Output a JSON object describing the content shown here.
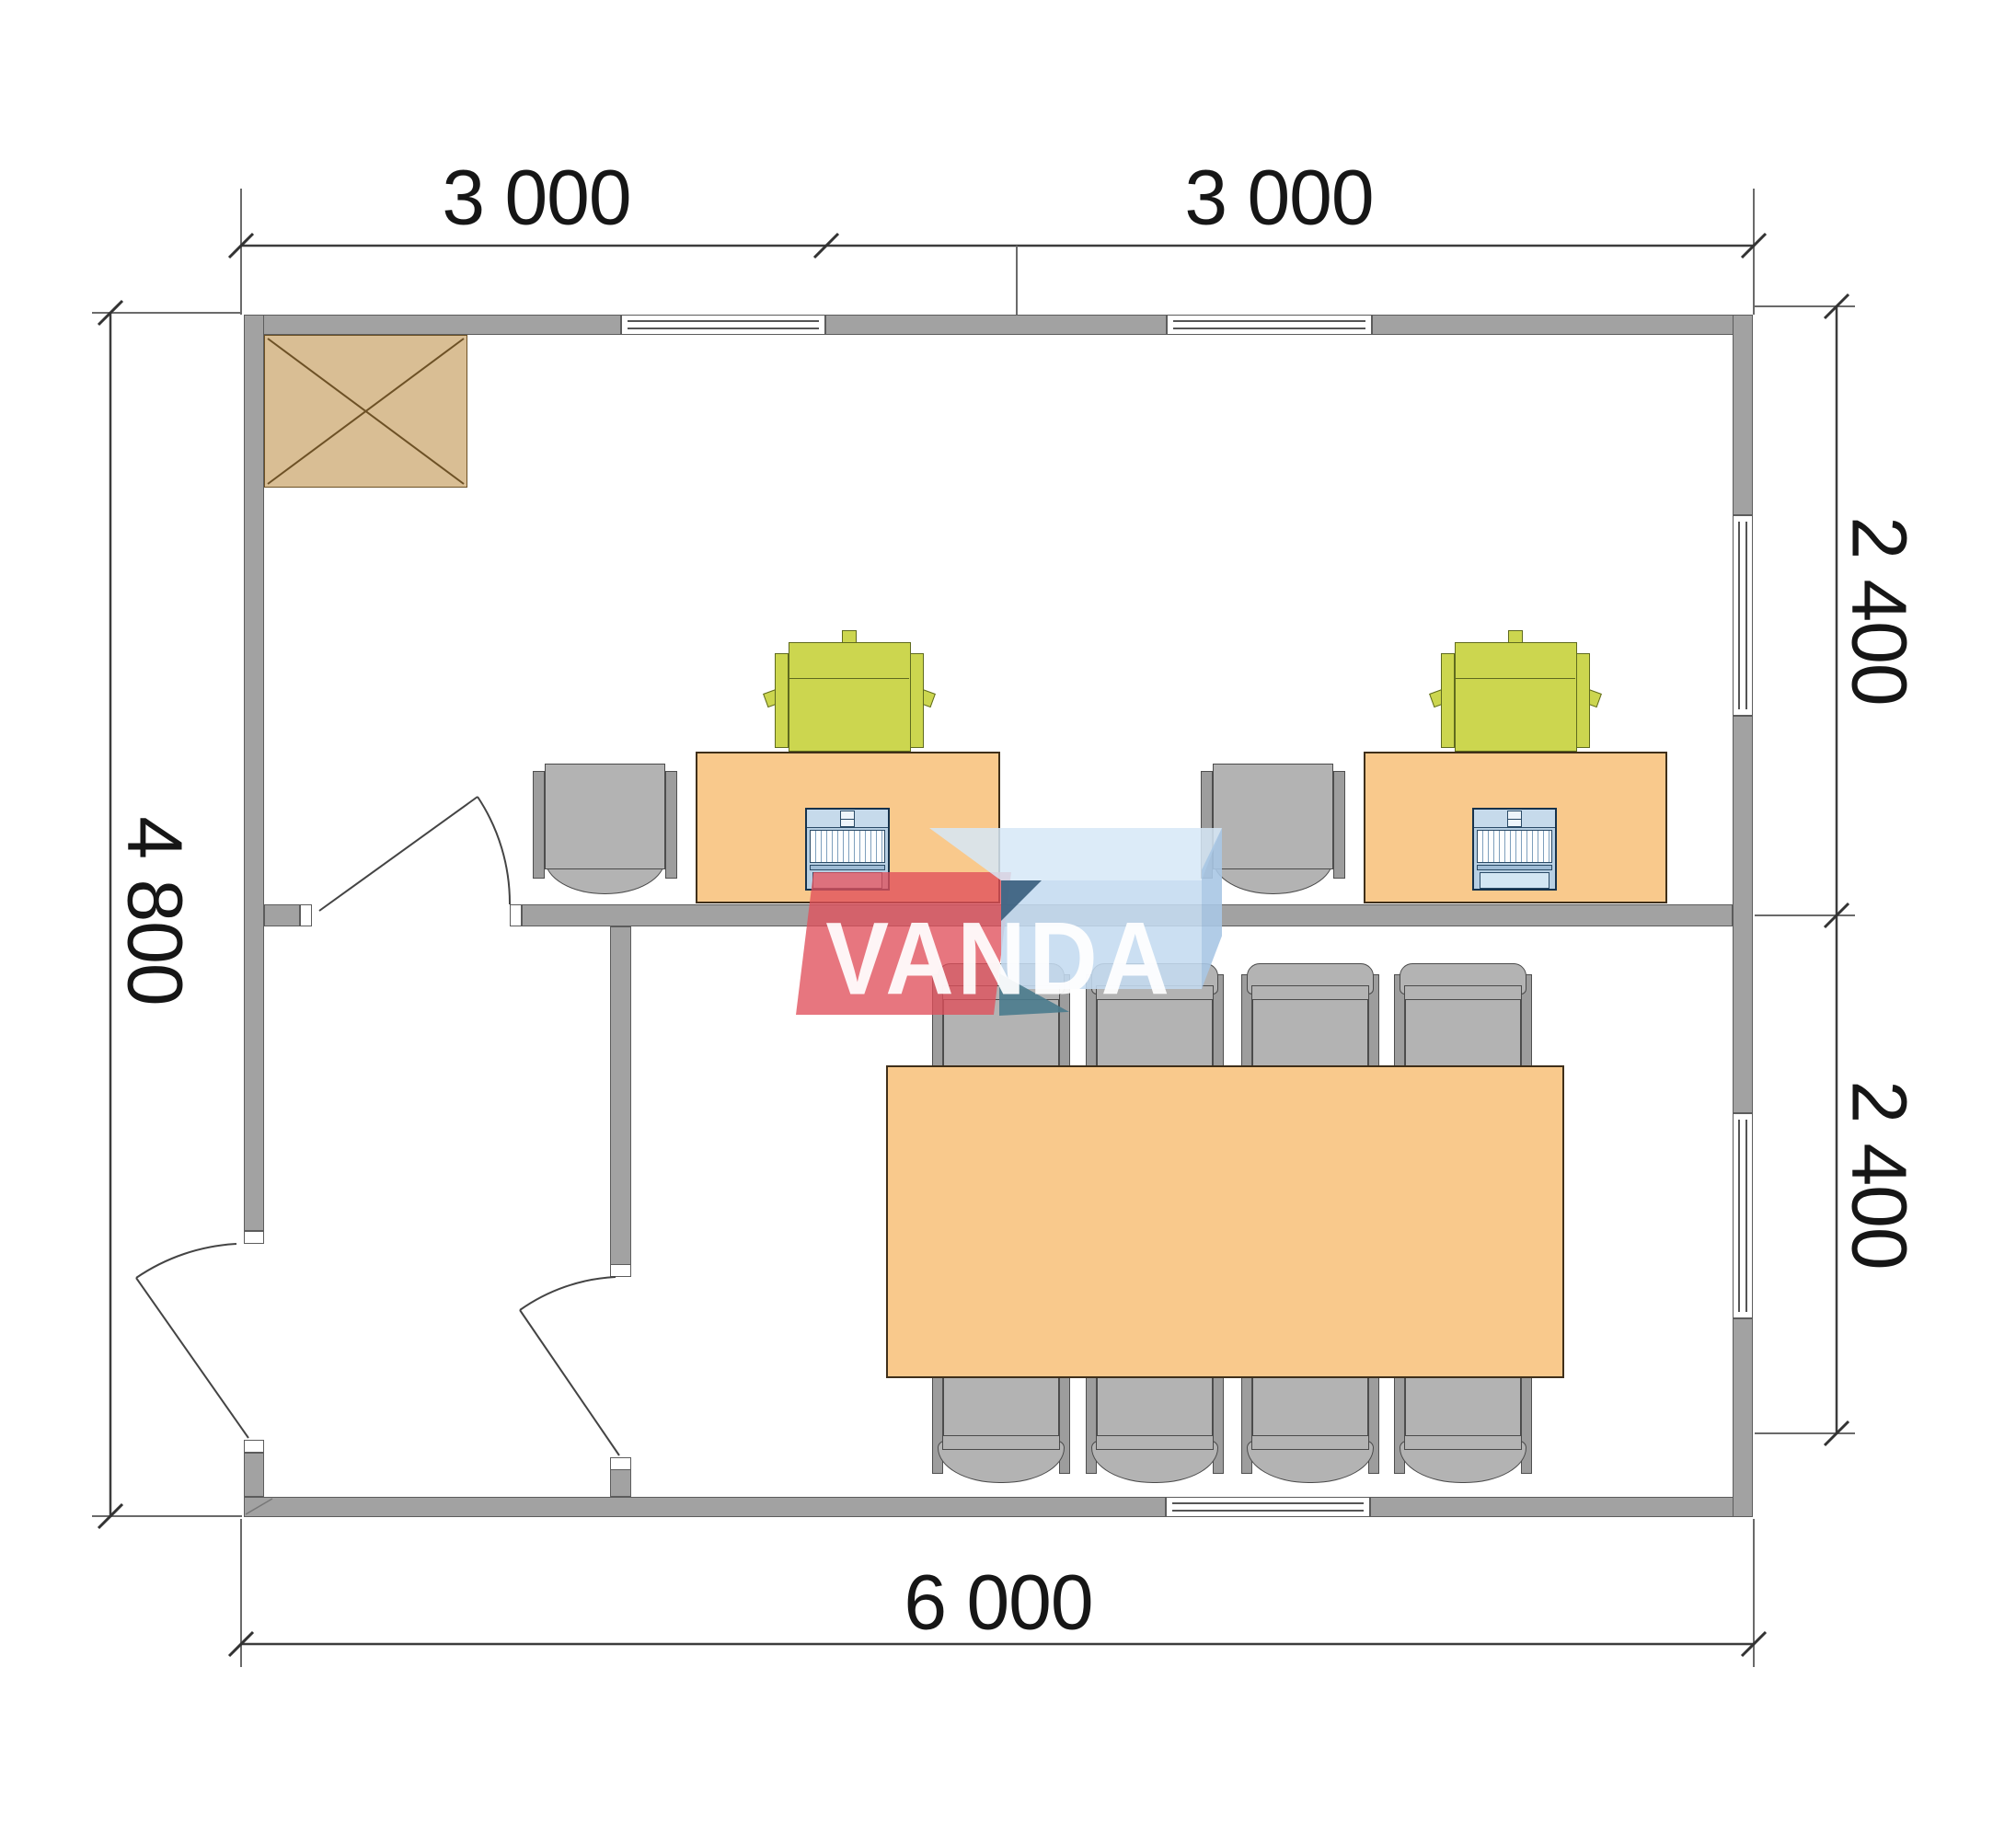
{
  "watermark": {
    "text": "VANDA"
  },
  "dimensions": {
    "top": [
      "3 000",
      "3 000"
    ],
    "bottom": "6 000",
    "left": "4 800",
    "right": [
      "2 400",
      "2 400"
    ]
  },
  "plan_objects": {
    "rooms": [
      "office-room",
      "meeting-room",
      "entry-vestibule"
    ],
    "furniture": [
      "wardrobe-cabinet",
      "office-desk",
      "office-desk",
      "desk-chair",
      "desk-chair",
      "task-chair",
      "task-chair",
      "laptop",
      "laptop",
      "meeting-table",
      "meeting-chair-x8"
    ],
    "openings": [
      "window-top-1",
      "window-top-2",
      "window-bottom",
      "window-right-upper",
      "window-right-lower",
      "door-exterior-left",
      "door-vestibule",
      "door-office"
    ]
  },
  "colors": {
    "wall": "#a2a2a2",
    "wall-line": "#5c5c5c",
    "desk": "#f9c98c",
    "table": "#f9c98c",
    "chair-gray": "#b3b3b3",
    "chair-strip": "#9d9d9d",
    "chair-green": "#ccd64f",
    "cabinet": "#d9be94",
    "laptop": "#b7cfe3",
    "laptop-screen": "#d3e6f3",
    "logo-red": "rgba(224,79,91,0.78)",
    "logo-blue": "rgba(196,219,240,0.88)",
    "logo-blue-top": "rgba(214,232,247,0.85)",
    "logo-dark": "#2f5676",
    "logo-teal": "#4a7b8d",
    "line": "#3c3c3c",
    "text": "#161616"
  }
}
